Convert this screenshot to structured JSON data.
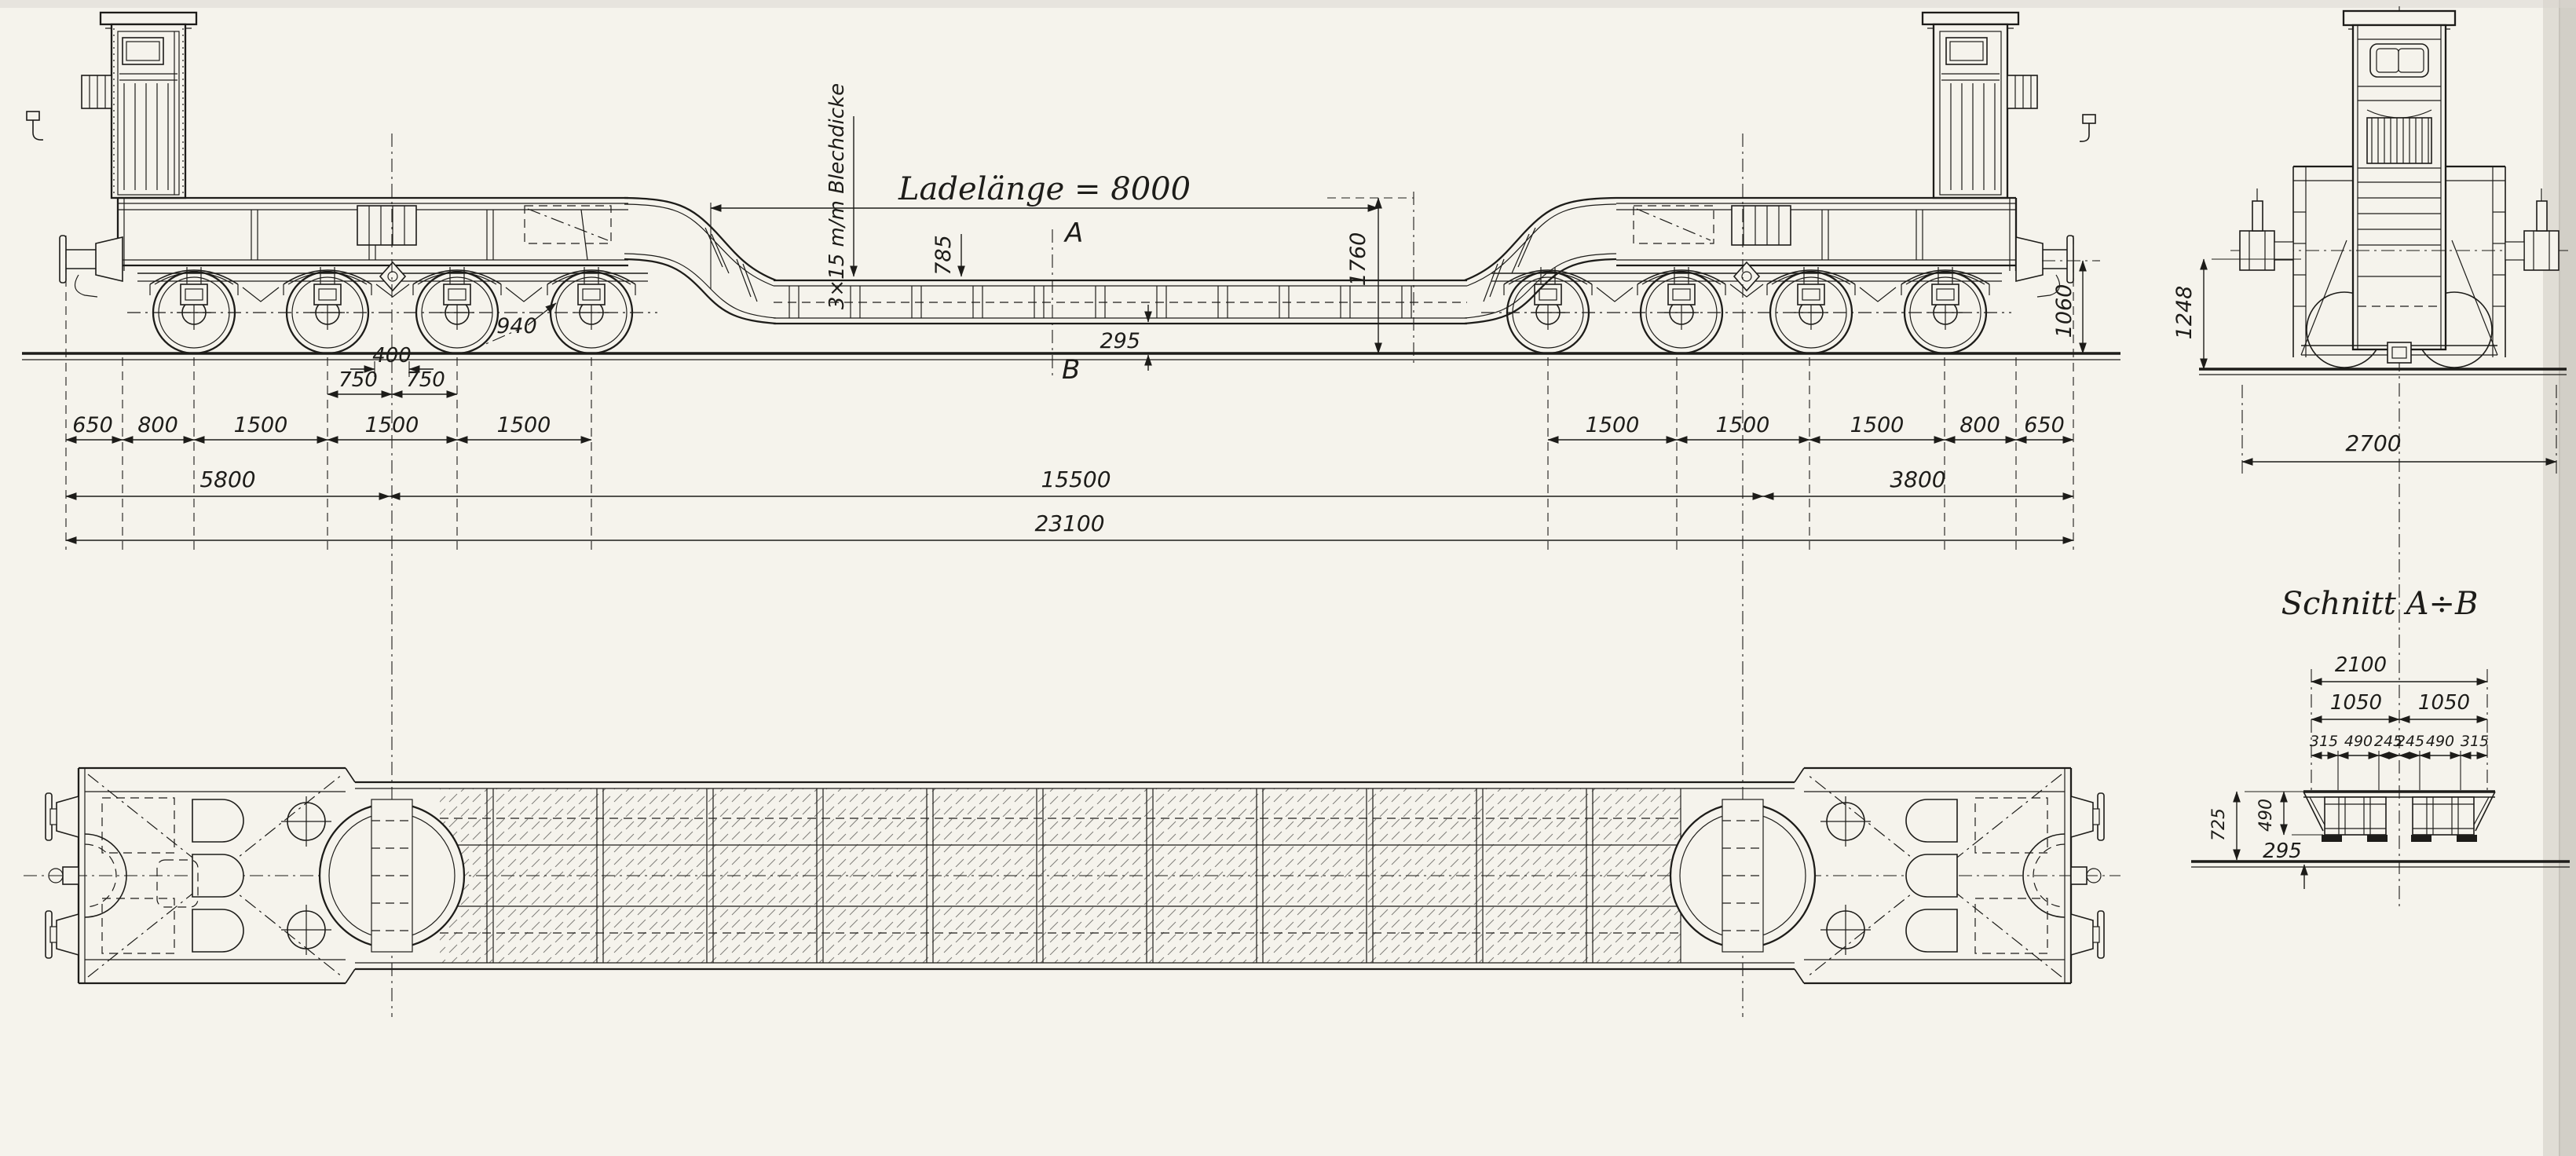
{
  "side_view": {
    "ladelaenge_label": "Ladelänge = 8000",
    "blechdicke_label": "3×15 m/m Blechdicke",
    "deck_height": "785",
    "under_clearance": "295",
    "section_marker_top": "A",
    "section_marker_bottom": "B",
    "gooseneck_height": "1760",
    "wheel_diameter": "940",
    "buffer_height": "1060",
    "axle_gap_top": "400",
    "axle_half_left": "750",
    "axle_half_right": "750",
    "left_chain": [
      "650",
      "800",
      "1500",
      "1500",
      "1500"
    ],
    "right_chain": [
      "1500",
      "1500",
      "1500",
      "800",
      "650"
    ],
    "overall_left": "5800",
    "overall_mid": "15500",
    "overall_right": "3800",
    "overall_total": "23100"
  },
  "end_view": {
    "height_1248": "1248",
    "width_2700": "2700"
  },
  "section_view": {
    "title": "Schnitt A÷B",
    "width_total": "2100",
    "width_half_left": "1050",
    "width_half_right": "1050",
    "sub_widths": [
      "315",
      "490",
      "245",
      "245",
      "490",
      "315"
    ],
    "height_725": "725",
    "height_490": "490",
    "height_295": "295"
  },
  "colors": {
    "ink": "#1d1c19",
    "paper": "#f5f3ec"
  }
}
